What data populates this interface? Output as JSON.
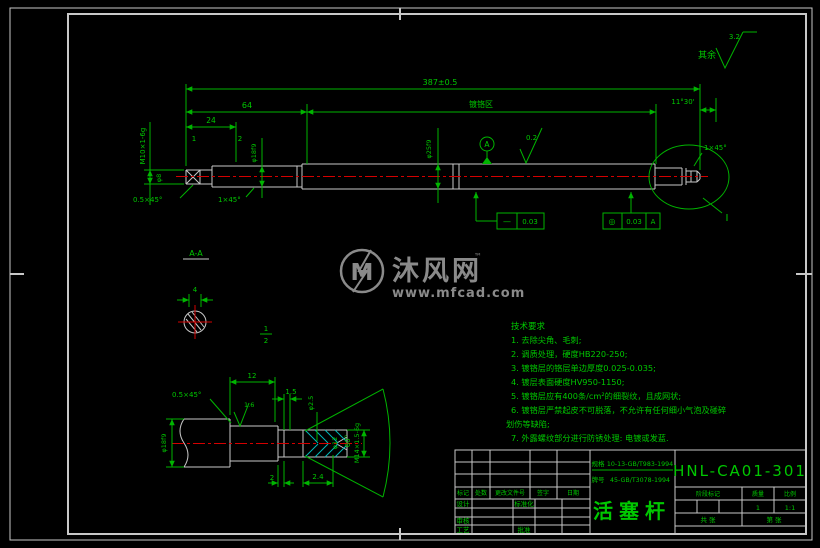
{
  "frame": {
    "surface_note_label": "其余",
    "surface_note_value": "3.2"
  },
  "main_view": {
    "dim_overall": "387±0.5",
    "dim_64": "64",
    "chrome_zone": "镀铬区",
    "dim_angle": "11°30'",
    "dim_24": "24",
    "tick1": "1",
    "tick2": "2",
    "thread_left": "M10×1-6g",
    "dia_relief": "φ8",
    "dia_18": "φ18f9",
    "chamfer_05": "0.5×45°",
    "chamfer_1": "1×45°",
    "dia_25": "φ25f9",
    "roughness": "0.2",
    "datum": "A",
    "chamfer_right": "1×45°",
    "detail_ref": "I",
    "tol1_symbol": "—",
    "tol1_value": "0.03",
    "tol2_symbol": "◎",
    "tol2_value": "0.03",
    "tol2_datum": "A"
  },
  "section_view": {
    "label": "A-A",
    "dim_4": "4",
    "frac_top": "1",
    "frac_bottom": "2"
  },
  "detail_view": {
    "chamfer": "0.5×45°",
    "dim_12": "12",
    "roughness": "1.6",
    "dim_15": "1.5",
    "dia_25": "φ2.5",
    "angle": "60°",
    "dia_12": "φ12",
    "thread": "M14×1.5-6g",
    "dia_18": "φ18f9",
    "dim_2": "2",
    "dim_24": "2.4"
  },
  "watermark": {
    "logo": "M",
    "brand": "沐风网",
    "tm": "™",
    "url": "www.mfcad.com"
  },
  "tech": {
    "title": "技术要求",
    "lines": [
      "1. 去除尖角、毛刺;",
      "2. 调质处理，硬度HB220-250;",
      "3. 镀铬层的铬层单边厚度0.025-0.035;",
      "4. 镀层表面硬度HV950-1150;",
      "5. 镀铬层应有400条/cm²的细裂纹，且成网状;",
      "6. 镀铬层严禁起皮不可脱落，不允许有任何细小气泡及碰碎",
      "划伤等缺陷;",
      "7. 外露螺纹部分进行防锈处理: 电镀或发蓝."
    ]
  },
  "title_block": {
    "drawing_no": "HNL-CA01-301",
    "part_name": "活塞杆",
    "spec_label": "规格",
    "spec_value": "10-13-GB/T983-1994",
    "grade_label": "牌号",
    "grade_value": "45-GB/T3078-1994",
    "rev_headers": [
      "标记",
      "处数",
      "更改文件号",
      "签字",
      "日期"
    ],
    "role_design": "设计",
    "role_standard": "标准化",
    "role_check": "审核",
    "role_process": "工艺",
    "role_approve": "批准",
    "stage_label": "阶段标记",
    "mass_label": "质量",
    "scale_label": "比例",
    "mass_value": "1",
    "scale_value": "1:1",
    "sheets_total": "共  张",
    "sheet_no": "第  张"
  }
}
